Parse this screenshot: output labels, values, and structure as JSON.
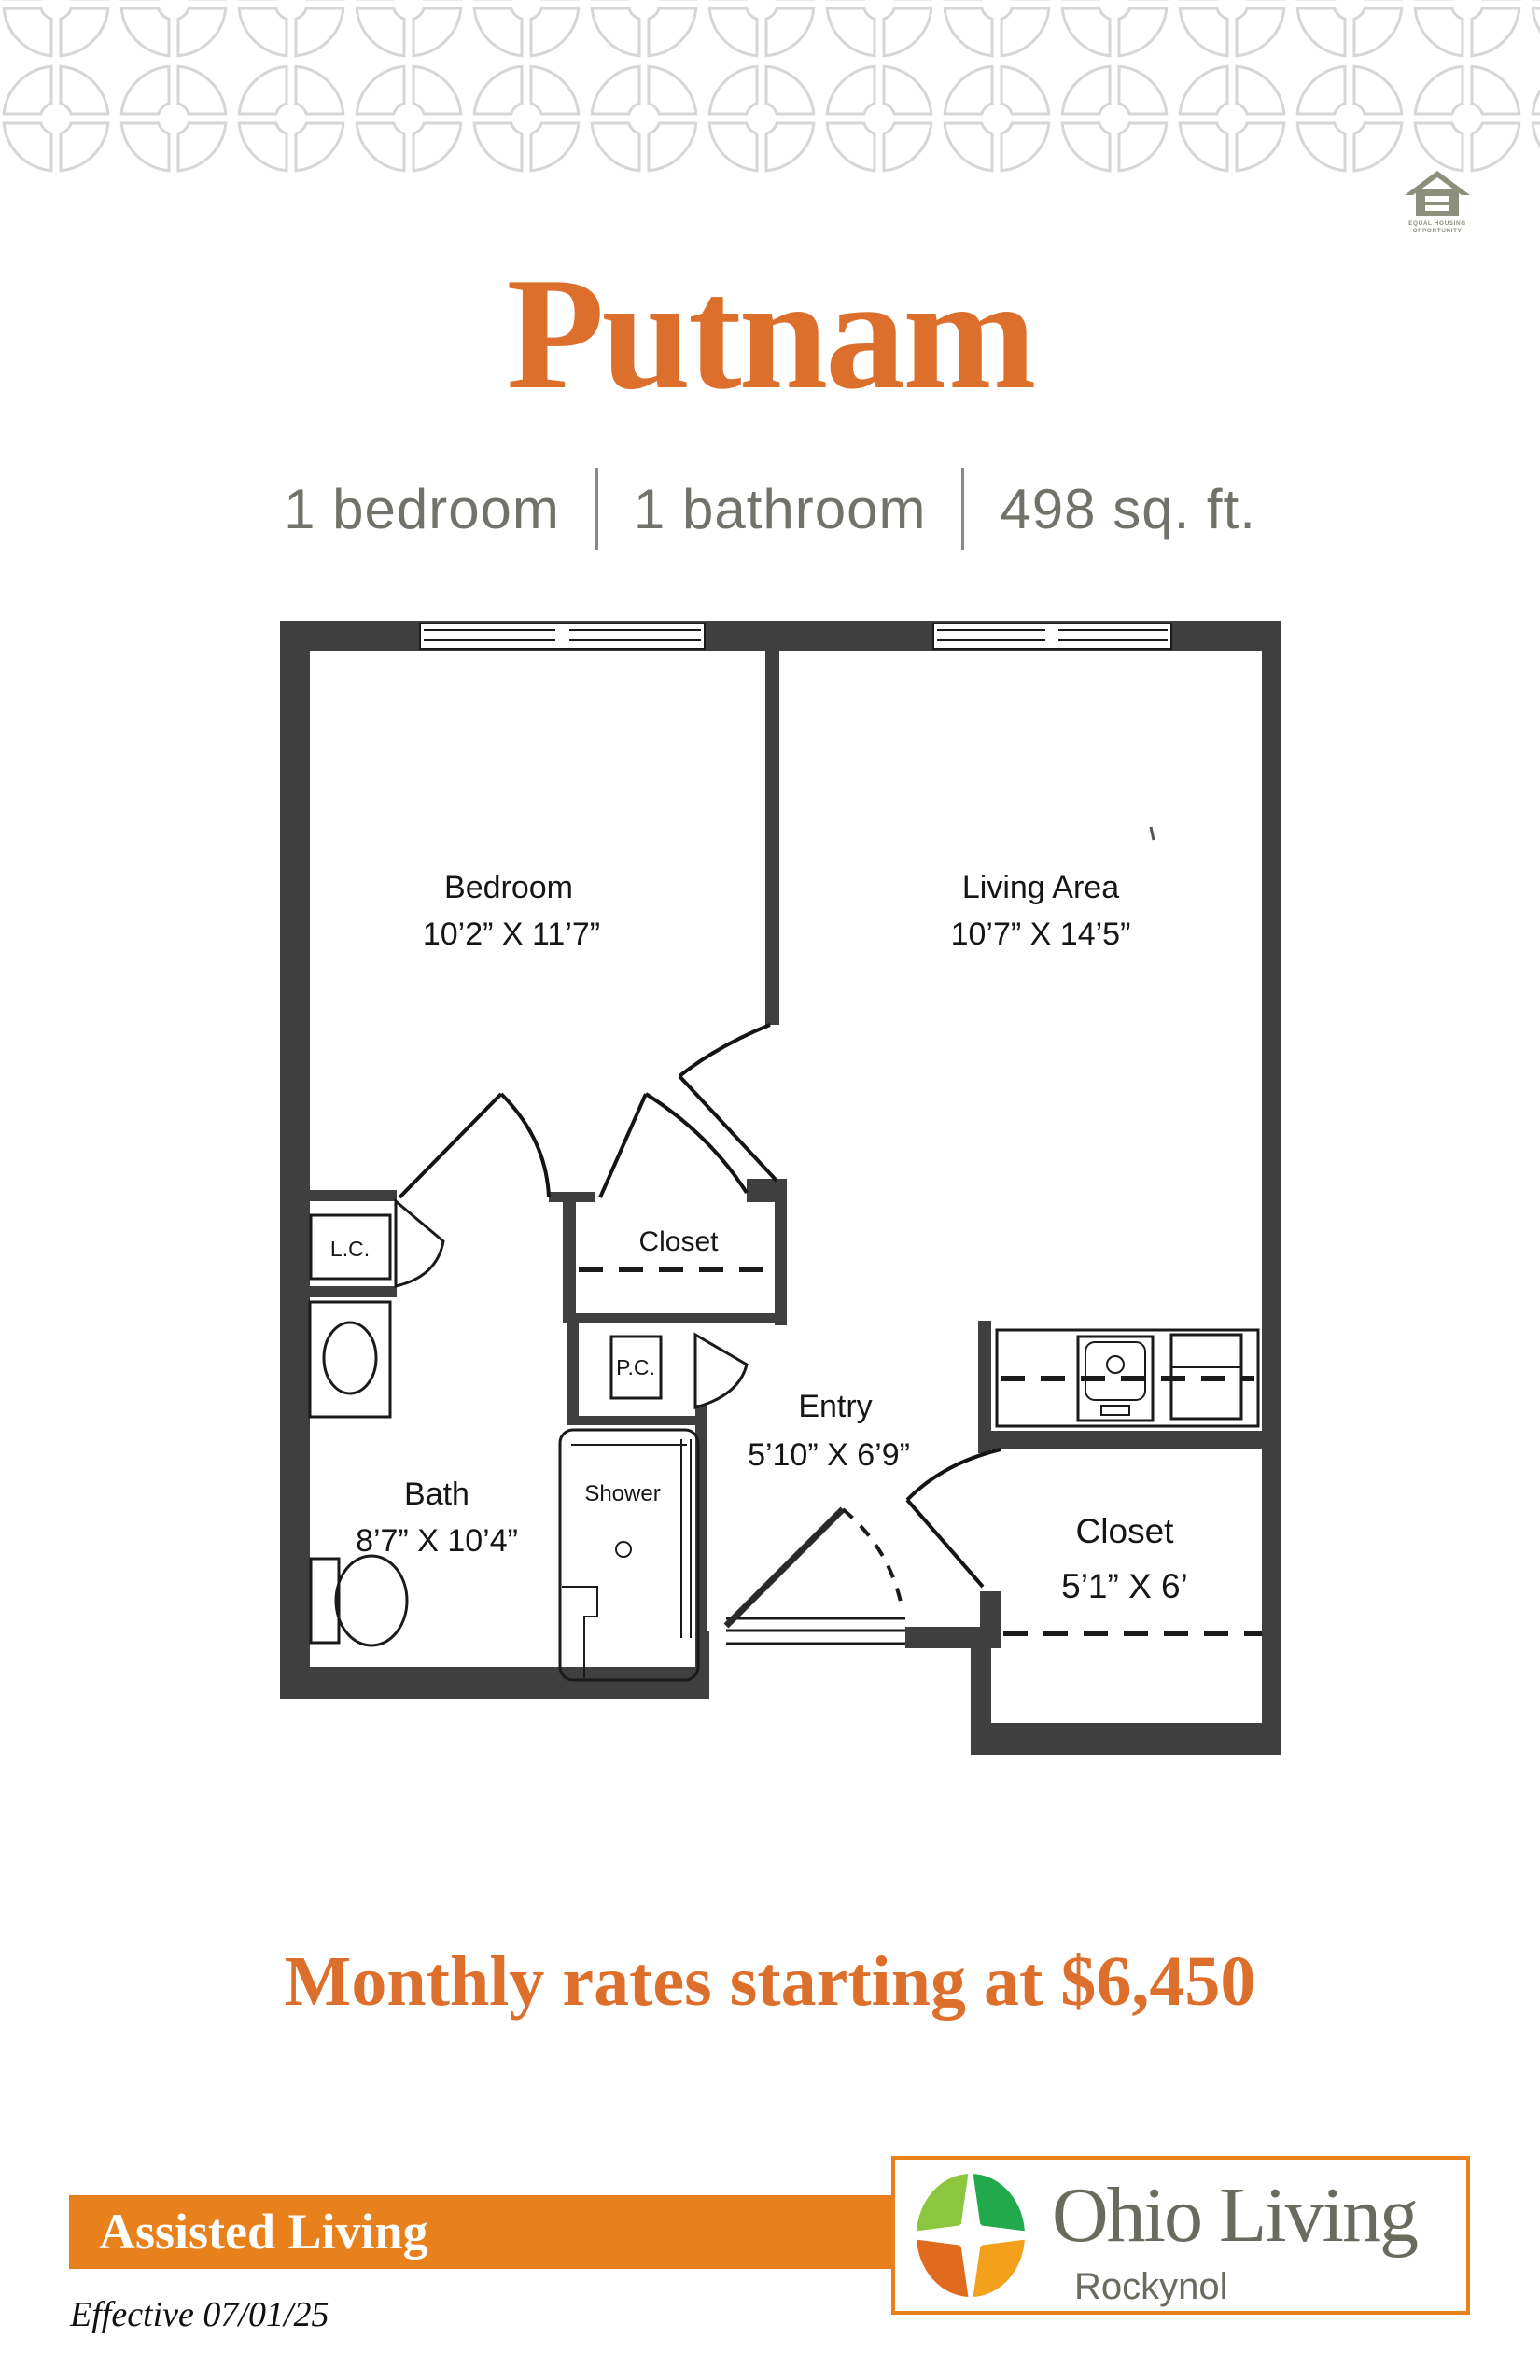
{
  "header": {
    "eho_line1": "EQUAL HOUSING",
    "eho_line2": "OPPORTUNITY",
    "title": "Putnam",
    "subtitle": {
      "item1": "1 bedroom",
      "item2": "1 bathroom",
      "item3": "498 sq. ft."
    }
  },
  "plan": {
    "bedroom": {
      "name": "Bedroom",
      "dims": "10’2” X 11’7”"
    },
    "living": {
      "name": "Living Area",
      "dims": "10’7” X 14’5”"
    },
    "closet_hall": {
      "name": "Closet"
    },
    "entry": {
      "name": "Entry",
      "dims": "5’10” X 6’9”"
    },
    "bath": {
      "name": "Bath",
      "dims": "8’7” X 10’4”"
    },
    "shower": {
      "name": "Shower"
    },
    "closet_entry": {
      "name": "Closet",
      "dims": "5’1” X 6’"
    },
    "lc": {
      "name": "L.C."
    },
    "pc": {
      "name": "P.C."
    }
  },
  "pricing": {
    "line": "Monthly rates starting at $6,450"
  },
  "footer": {
    "band": "Assisted Living",
    "effective": "Effective 07/01/25",
    "logo": {
      "brand": "Ohio Living",
      "community": "Rockynol"
    }
  },
  "colors": {
    "accent_text": "#dd6f2c",
    "band_orange": "#e8811c",
    "pattern_gray": "#d6d6d6",
    "eho_gray": "#8e8e7c",
    "logo_text_gray": "#696b5e",
    "logo_green_light": "#8cc63e",
    "logo_green": "#22a94c",
    "logo_orange": "#e06a1e",
    "logo_amber": "#f3a01c",
    "wall_dark": "#3f3f3f"
  }
}
